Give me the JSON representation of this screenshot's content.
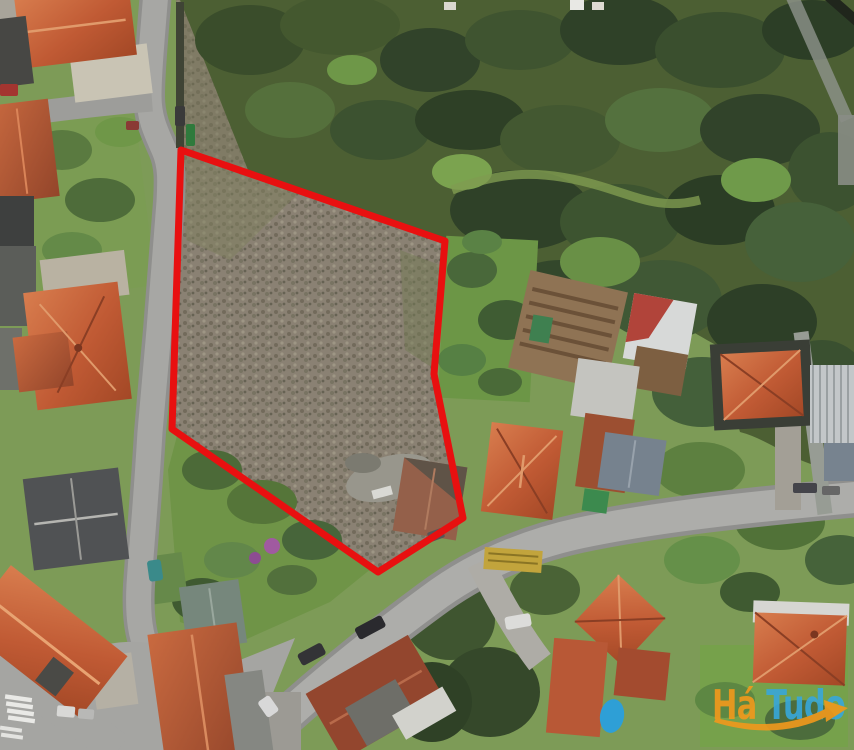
{
  "scene": {
    "kind": "aerial satellite photo of a building plot outlined for sale",
    "parcel": {
      "outline_points": "181,150 445,241 434,374 463,518 378,572 172,429",
      "outline_color": "#e81010",
      "outline_width": "7"
    },
    "palette": {
      "parcel_red": "#e81010",
      "forest_green": "#4c5f33",
      "grass_green": "#6f9447",
      "scrub_brown": "#8a8173",
      "road_gray": "#a7a7a4",
      "roof_terracotta": "#c4613b",
      "logo_orange": "#f2991c",
      "logo_blue": "#38a7da"
    }
  },
  "watermark": {
    "brand_orange": "Há",
    "brand_blue": "Tudo",
    "brand_full": "HáTudo"
  }
}
